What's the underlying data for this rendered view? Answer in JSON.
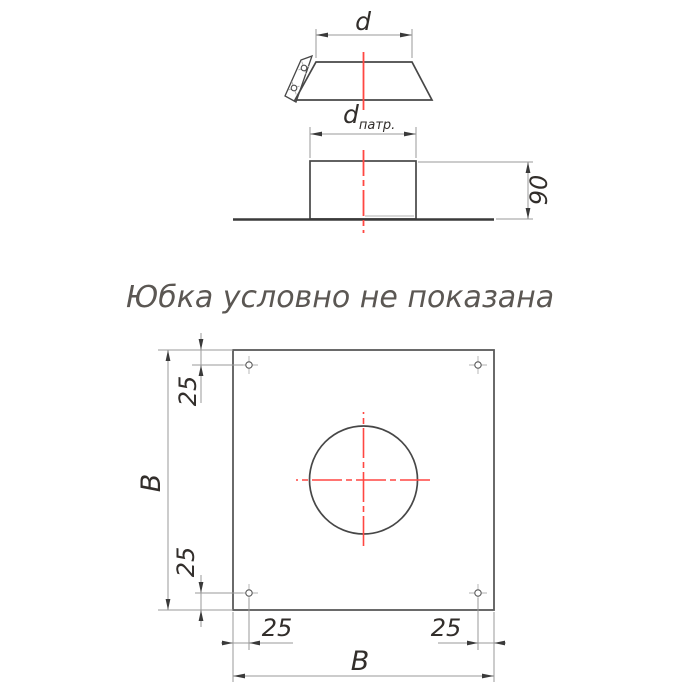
{
  "colors": {
    "background": "#ffffff",
    "object_line": "#474747",
    "thin_line": "#9a9a9a",
    "centerline_red": "#ff4742",
    "dimension_text": "#322e2b",
    "note_text": "#5b5753"
  },
  "views": {
    "skirt": {
      "description": "skirt-side-view",
      "dim_d": "d"
    },
    "stub": {
      "description": "stub-on-plate-side-view",
      "dim_d_main": "d",
      "dim_d_sub": "патр.",
      "dim_height": "90"
    },
    "note": "Юбка условно не показана",
    "plan": {
      "description": "plate-plan-view",
      "dim_b_left": "B",
      "dim_b_bottom": "B",
      "dim_25_top_left": "25",
      "dim_25_bottom_left": "25",
      "dim_25_bottom_h_left": "25",
      "dim_25_bottom_h_right": "25"
    }
  }
}
